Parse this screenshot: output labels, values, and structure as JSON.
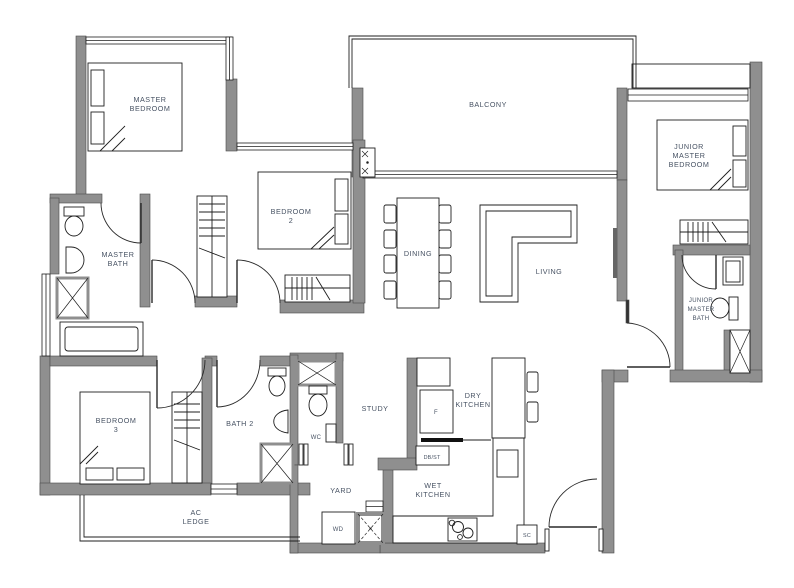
{
  "plan": {
    "kind": "residential-floor-plan"
  },
  "labels": {
    "master_bedroom": [
      "MASTER",
      "BEDROOM"
    ],
    "bedroom_2": [
      "BEDROOM",
      "2"
    ],
    "balcony": [
      "BALCONY"
    ],
    "junior_master_bedroom": [
      "JUNIOR",
      "MASTER",
      "BEDROOM"
    ],
    "master_bath": [
      "MASTER",
      "BATH"
    ],
    "dining": [
      "DINING"
    ],
    "living": [
      "LIVING"
    ],
    "junior_master_bath": [
      "JUNIOR",
      "MASTER",
      "BATH"
    ],
    "bedroom_3": [
      "BEDROOM",
      "3"
    ],
    "bath_2": [
      "BATH 2"
    ],
    "wc": [
      "WC"
    ],
    "study": [
      "STUDY"
    ],
    "dry_kitchen": [
      "DRY",
      "KITCHEN"
    ],
    "fridge": [
      "F"
    ],
    "db_st": [
      "DB/ST"
    ],
    "yard": [
      "YARD"
    ],
    "wet_kitchen": [
      "WET",
      "KITCHEN"
    ],
    "washer_dryer": [
      "WD"
    ],
    "ac_ledge": [
      "AC",
      "LEDGE"
    ],
    "shoe_cabinet": [
      "SC"
    ]
  },
  "colors": {
    "wall": "#8f8f8f",
    "line": "#1f1f1f",
    "label": "#475263",
    "background": "#ffffff"
  }
}
